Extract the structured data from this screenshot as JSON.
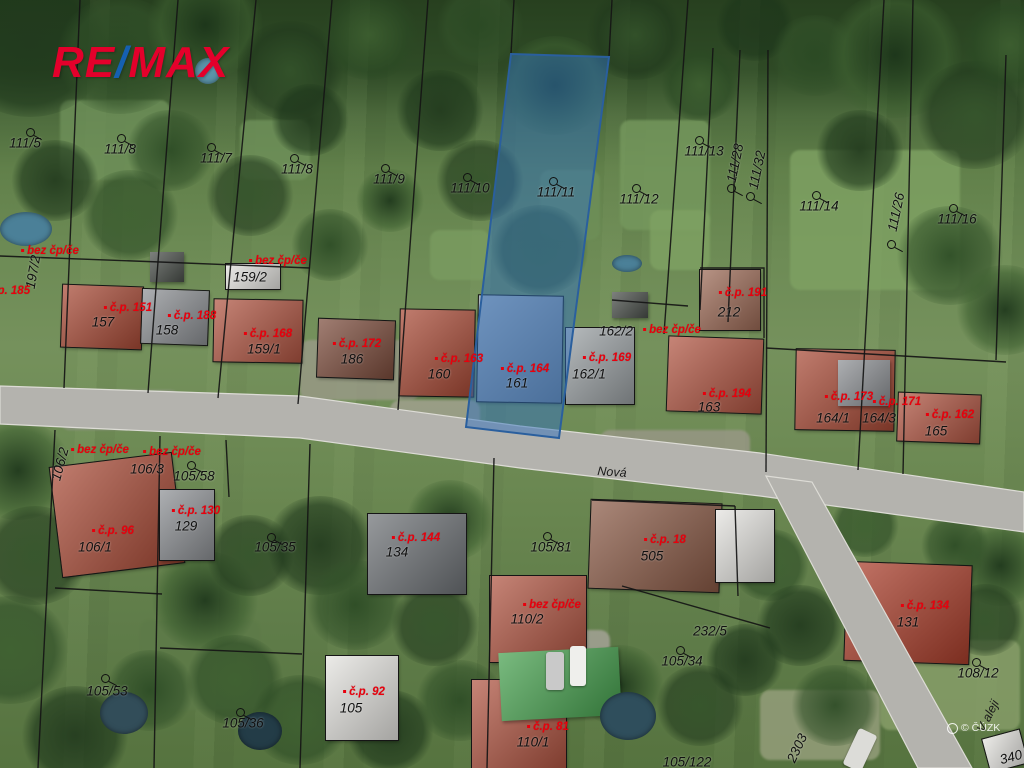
{
  "branding": {
    "logo_re": "RE",
    "logo_slash": "/",
    "logo_max": "MAX",
    "logo_red": "#e4002b",
    "logo_blue": "#1560b0"
  },
  "watermark": {
    "text": "© ČÚZK"
  },
  "map": {
    "type": "cadastral-aerial",
    "accent_red": "#e8000d",
    "line_color": "#151515",
    "highlight": {
      "parcel_text": "111/11",
      "building_text": "161",
      "fill": "rgba(47,111,188,0.5)",
      "stroke": "#2a5f9e",
      "polygon": [
        [
          511,
          54
        ],
        [
          609,
          57
        ],
        [
          559,
          438
        ],
        [
          466,
          427
        ]
      ]
    },
    "streets": [
      {
        "name": "Nová",
        "x": 612,
        "y": 472,
        "rot": 4
      },
      {
        "name": "V aleji",
        "x": 988,
        "y": 716,
        "rot": -63
      }
    ],
    "parcel_labels": [
      {
        "text": "111/5",
        "x": 25,
        "y": 143,
        "rot": 0,
        "circle": true,
        "cx": 26,
        "cy": 128
      },
      {
        "text": "111/8",
        "x": 120,
        "y": 149,
        "rot": 0,
        "circle": true,
        "cx": 117,
        "cy": 134
      },
      {
        "text": "111/7",
        "x": 216,
        "y": 158,
        "rot": 0,
        "circle": true,
        "cx": 207,
        "cy": 143
      },
      {
        "text": "111/8",
        "x": 297,
        "y": 169,
        "rot": 0,
        "circle": true,
        "cx": 290,
        "cy": 154
      },
      {
        "text": "111/9",
        "x": 389,
        "y": 179,
        "rot": 0,
        "circle": true,
        "cx": 381,
        "cy": 164
      },
      {
        "text": "111/10",
        "x": 470,
        "y": 188,
        "rot": 0,
        "circle": true,
        "cx": 463,
        "cy": 173
      },
      {
        "text": "111/11",
        "x": 556,
        "y": 192,
        "rot": 0,
        "circle": true,
        "cx": 549,
        "cy": 177
      },
      {
        "text": "111/12",
        "x": 639,
        "y": 199,
        "rot": 0,
        "circle": true,
        "cx": 632,
        "cy": 184
      },
      {
        "text": "111/13",
        "x": 704,
        "y": 151,
        "rot": 0,
        "circle": true,
        "cx": 695,
        "cy": 136
      },
      {
        "text": "111/28",
        "x": 735,
        "y": 163,
        "rot": -78,
        "circle": true,
        "cx": 727,
        "cy": 184
      },
      {
        "text": "111/32",
        "x": 757,
        "y": 170,
        "rot": -78,
        "circle": true,
        "cx": 746,
        "cy": 192
      },
      {
        "text": "111/14",
        "x": 819,
        "y": 206,
        "rot": 0,
        "circle": true,
        "cx": 812,
        "cy": 191
      },
      {
        "text": "111/26",
        "x": 896,
        "y": 212,
        "rot": -78,
        "circle": true,
        "cx": 887,
        "cy": 240
      },
      {
        "text": "111/16",
        "x": 957,
        "y": 219,
        "rot": 0,
        "circle": true,
        "cx": 949,
        "cy": 204
      },
      {
        "text": "197/2",
        "x": 33,
        "y": 272,
        "rot": -80,
        "circle": false
      },
      {
        "text": "159/2",
        "x": 250,
        "y": 277,
        "rot": 0,
        "circle": false
      },
      {
        "text": "157",
        "x": 103,
        "y": 322,
        "rot": 0,
        "circle": false
      },
      {
        "text": "158",
        "x": 167,
        "y": 330,
        "rot": 0,
        "circle": false
      },
      {
        "text": "159/1",
        "x": 264,
        "y": 349,
        "rot": 0,
        "circle": false
      },
      {
        "text": "186",
        "x": 352,
        "y": 359,
        "rot": 0,
        "circle": false
      },
      {
        "text": "160",
        "x": 439,
        "y": 374,
        "rot": 0,
        "circle": false
      },
      {
        "text": "161",
        "x": 517,
        "y": 383,
        "rot": 0,
        "circle": false
      },
      {
        "text": "162/2",
        "x": 616,
        "y": 331,
        "rot": 0,
        "circle": false
      },
      {
        "text": "162/1",
        "x": 589,
        "y": 374,
        "rot": 0,
        "circle": false
      },
      {
        "text": "212",
        "x": 729,
        "y": 312,
        "rot": 0,
        "circle": false
      },
      {
        "text": "163",
        "x": 709,
        "y": 407,
        "rot": 0,
        "circle": false
      },
      {
        "text": "164/1",
        "x": 833,
        "y": 418,
        "rot": 0,
        "circle": false
      },
      {
        "text": "164/3",
        "x": 879,
        "y": 418,
        "rot": 0,
        "circle": false
      },
      {
        "text": "165",
        "x": 936,
        "y": 431,
        "rot": 0,
        "circle": false
      },
      {
        "text": "106/2",
        "x": 60,
        "y": 464,
        "rot": -75,
        "circle": false
      },
      {
        "text": "106/3",
        "x": 147,
        "y": 469,
        "rot": 0,
        "circle": false
      },
      {
        "text": "105/58",
        "x": 194,
        "y": 476,
        "rot": 0,
        "circle": true,
        "cx": 187,
        "cy": 461
      },
      {
        "text": "129",
        "x": 186,
        "y": 526,
        "rot": 0,
        "circle": false
      },
      {
        "text": "106/1",
        "x": 95,
        "y": 547,
        "rot": 0,
        "circle": false
      },
      {
        "text": "105/35",
        "x": 275,
        "y": 547,
        "rot": 0,
        "circle": true,
        "cx": 267,
        "cy": 533
      },
      {
        "text": "134",
        "x": 397,
        "y": 552,
        "rot": 0,
        "circle": false
      },
      {
        "text": "105/81",
        "x": 551,
        "y": 547,
        "rot": 0,
        "circle": true,
        "cx": 543,
        "cy": 532
      },
      {
        "text": "505",
        "x": 652,
        "y": 556,
        "rot": 0,
        "circle": false
      },
      {
        "text": "110/2",
        "x": 527,
        "y": 619,
        "rot": 0,
        "circle": false
      },
      {
        "text": "232/5",
        "x": 710,
        "y": 631,
        "rot": 0,
        "circle": false
      },
      {
        "text": "105/34",
        "x": 682,
        "y": 661,
        "rot": 0,
        "circle": true,
        "cx": 676,
        "cy": 646
      },
      {
        "text": "131",
        "x": 908,
        "y": 622,
        "rot": 0,
        "circle": false
      },
      {
        "text": "108/12",
        "x": 978,
        "y": 673,
        "rot": 0,
        "circle": true,
        "cx": 972,
        "cy": 658
      },
      {
        "text": "105/53",
        "x": 107,
        "y": 691,
        "rot": 0,
        "circle": true,
        "cx": 101,
        "cy": 674
      },
      {
        "text": "105/36",
        "x": 243,
        "y": 723,
        "rot": 0,
        "circle": true,
        "cx": 236,
        "cy": 708
      },
      {
        "text": "105",
        "x": 351,
        "y": 708,
        "rot": 0,
        "circle": false
      },
      {
        "text": "110/1",
        "x": 533,
        "y": 742,
        "rot": 0,
        "circle": false
      },
      {
        "text": "105/122",
        "x": 687,
        "y": 762,
        "rot": 0,
        "circle": false
      },
      {
        "text": "2303",
        "x": 797,
        "y": 748,
        "rot": -65,
        "circle": false
      },
      {
        "text": "340",
        "x": 1011,
        "y": 757,
        "rot": -15,
        "circle": false
      }
    ],
    "house_labels": [
      {
        "text": "bez čp/če",
        "x": 50,
        "y": 251
      },
      {
        "text": "č.p. 185",
        "x": 6,
        "y": 291
      },
      {
        "text": "č.p. 151",
        "x": 128,
        "y": 308
      },
      {
        "text": "č.p. 188",
        "x": 192,
        "y": 316
      },
      {
        "text": "bez čp/če",
        "x": 278,
        "y": 261
      },
      {
        "text": "č.p. 168",
        "x": 268,
        "y": 334
      },
      {
        "text": "č.p. 172",
        "x": 357,
        "y": 344
      },
      {
        "text": "č.p. 163",
        "x": 459,
        "y": 359
      },
      {
        "text": "č.p. 164",
        "x": 525,
        "y": 369
      },
      {
        "text": "č.p. 169",
        "x": 607,
        "y": 358
      },
      {
        "text": "bez čp/če",
        "x": 672,
        "y": 330
      },
      {
        "text": "č.p. 191",
        "x": 743,
        "y": 293
      },
      {
        "text": "č.p. 194",
        "x": 727,
        "y": 394
      },
      {
        "text": "č.p. 173",
        "x": 849,
        "y": 397
      },
      {
        "text": "č.p. 171",
        "x": 897,
        "y": 402
      },
      {
        "text": "č.p. 162",
        "x": 950,
        "y": 415
      },
      {
        "text": "bez čp/če",
        "x": 100,
        "y": 450
      },
      {
        "text": "bez čp/če",
        "x": 172,
        "y": 452
      },
      {
        "text": "č.p. 130",
        "x": 196,
        "y": 511
      },
      {
        "text": "č.p. 96",
        "x": 113,
        "y": 531
      },
      {
        "text": "č.p. 144",
        "x": 416,
        "y": 538
      },
      {
        "text": "č.p. 18",
        "x": 665,
        "y": 540
      },
      {
        "text": "bez čp/če",
        "x": 552,
        "y": 605
      },
      {
        "text": "č.p. 134",
        "x": 925,
        "y": 606
      },
      {
        "text": "č.p. 92",
        "x": 364,
        "y": 692
      },
      {
        "text": "č.p. 81",
        "x": 548,
        "y": 727
      }
    ]
  }
}
